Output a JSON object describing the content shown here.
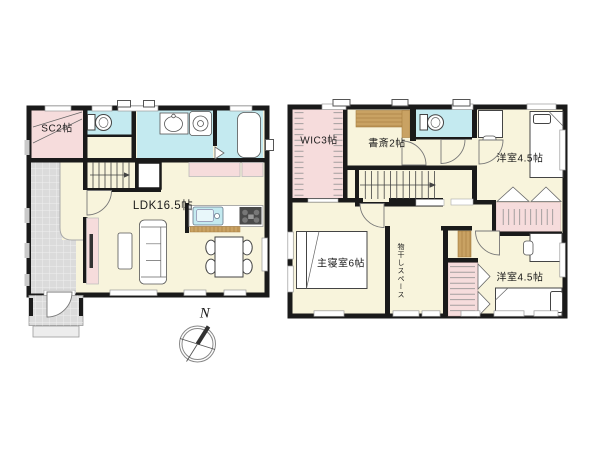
{
  "colors": {
    "wall": "#1A1A1A",
    "floor": "#F8F4DC",
    "closet_pink": "#F6DCDC",
    "wet_area_cyan": "#C4EAF0",
    "wood_tan": "#C9A263",
    "tile_gray": "#DBDBDB",
    "porch_step": "#EDEDED"
  },
  "plan_left": {
    "rooms": {
      "shoe_closet": {
        "label": "SC2帖"
      },
      "ldk": {
        "label": "LDK16.5帖"
      }
    }
  },
  "plan_right": {
    "rooms": {
      "walk_in_closet": {
        "label": "WIC3帖"
      },
      "study": {
        "label": "書斎2帖"
      },
      "western_room_top": {
        "label": "洋室4.5帖"
      },
      "master_bedroom": {
        "label": "主寝室6帖"
      },
      "laundry_space": {
        "label": "物干しスペース"
      },
      "western_room_bottom": {
        "label": "洋室4.5帖"
      }
    }
  },
  "compass": {
    "north_label": "N"
  }
}
